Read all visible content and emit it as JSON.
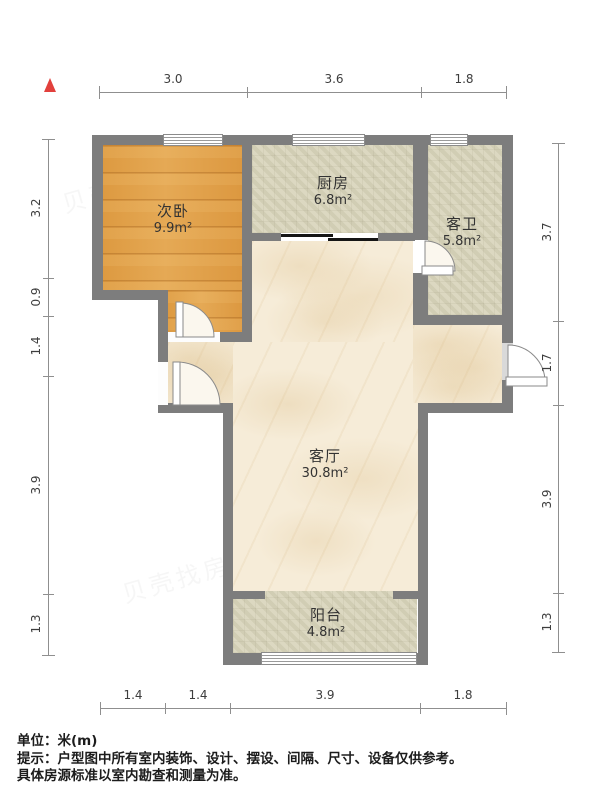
{
  "rooms": [
    {
      "name": "次卧",
      "area": "9.9m²"
    },
    {
      "name": "厨房",
      "area": "6.8m²"
    },
    {
      "name": "客卫",
      "area": "5.8m²"
    },
    {
      "name": "客厅",
      "area": "30.8m²"
    },
    {
      "name": "阳台",
      "area": "4.8m²"
    }
  ],
  "dimensions": {
    "top": [
      "3.0",
      "3.6",
      "1.8"
    ],
    "bottom": [
      "1.4",
      "1.4",
      "3.9",
      "1.8"
    ],
    "left": [
      "3.2",
      "0.9",
      "1.4",
      "3.9",
      "1.3"
    ],
    "right": [
      "3.7",
      "1.7",
      "3.9",
      "1.3"
    ]
  },
  "footer": {
    "unit_label": "单位：米(m)",
    "note_line1": "提示：户型图中所有室内装饰、设计、摆设、间隔、尺寸、设备仅供参考。",
    "note_line2": "具体房源标准以室内勘查和测量为准。"
  },
  "watermark": {
    "text": "贝壳找房"
  },
  "colors": {
    "wall": "#7d7d7d",
    "wood_floor": "#e0a04a",
    "tile_floor": "#d8d4ba",
    "marble_floor": "#f6ecd8",
    "north_arrow": "#e2403c",
    "dim_line": "#8f8f8f"
  }
}
